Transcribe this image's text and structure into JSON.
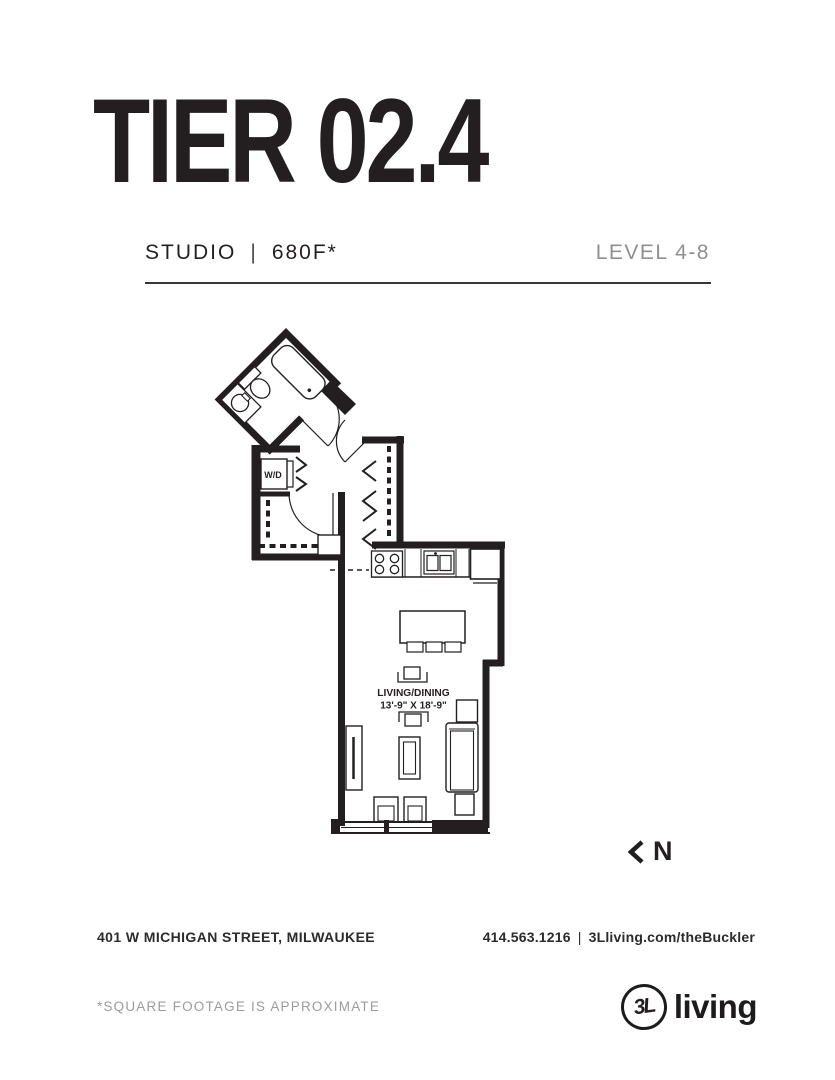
{
  "header": {
    "title": "TIER 02.4",
    "unit_type": "STUDIO",
    "separator": "|",
    "area": "680F*",
    "level": "LEVEL 4-8"
  },
  "plan": {
    "wd_label": "W/D",
    "room_label": "LIVING/DINING",
    "room_dimensions": "13'-9\" X 18'-9\"",
    "north_letter": "N"
  },
  "footer": {
    "address": "401 W MICHIGAN STREET, MILWAUKEE",
    "phone": "414.563.1216",
    "separator": "|",
    "website": "3Lliving.com/theBuckler",
    "disclaimer": "*SQUARE FOOTAGE IS APPROXIMATE",
    "logo_mark": "3L",
    "logo_text": "living"
  },
  "colors": {
    "ink": "#231f20",
    "gray": "#8f8f8f"
  }
}
